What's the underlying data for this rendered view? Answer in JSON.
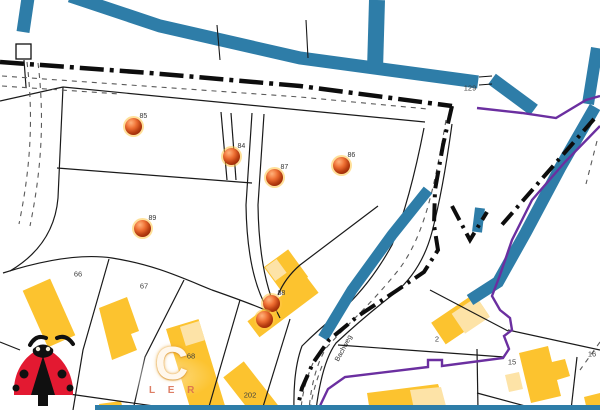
{
  "map": {
    "street_label": {
      "text": "Bachweg"
    },
    "parcel_labels": [
      {
        "text": "129",
        "x": 470,
        "y": 88
      },
      {
        "text": "66",
        "x": 78,
        "y": 274
      },
      {
        "text": "67",
        "x": 144,
        "y": 286
      },
      {
        "text": "68",
        "x": 191,
        "y": 356
      },
      {
        "text": "202",
        "x": 250,
        "y": 395
      },
      {
        "text": "2",
        "x": 437,
        "y": 339
      },
      {
        "text": "15",
        "x": 512,
        "y": 362
      },
      {
        "text": "16",
        "x": 592,
        "y": 354
      }
    ],
    "markers": [
      {
        "label": "85",
        "x": 133,
        "y": 126
      },
      {
        "label": "84",
        "x": 231,
        "y": 156
      },
      {
        "label": "87",
        "x": 274,
        "y": 177
      },
      {
        "label": "86",
        "x": 341,
        "y": 165
      },
      {
        "label": "89",
        "x": 142,
        "y": 228
      },
      {
        "label": "88",
        "x": 271,
        "y": 303
      },
      {
        "label": "",
        "x": 264,
        "y": 319
      }
    ],
    "watermark": {
      "big_letter": "C",
      "small_letters": "L E R"
    },
    "colors": {
      "water": "#2e7da8",
      "building": "#fcc32f",
      "building_light": "#fde3a7",
      "municipal_boundary": "#6b2fa0",
      "parcel_line": "#1a1a1a",
      "path_dashed": "#5a5a5a",
      "marker_fill": "#d9541e",
      "marker_ring": "#ffc33e",
      "label_text": "#3f3f3f",
      "logo_red": "#e31931",
      "logo_black": "#101010"
    }
  }
}
